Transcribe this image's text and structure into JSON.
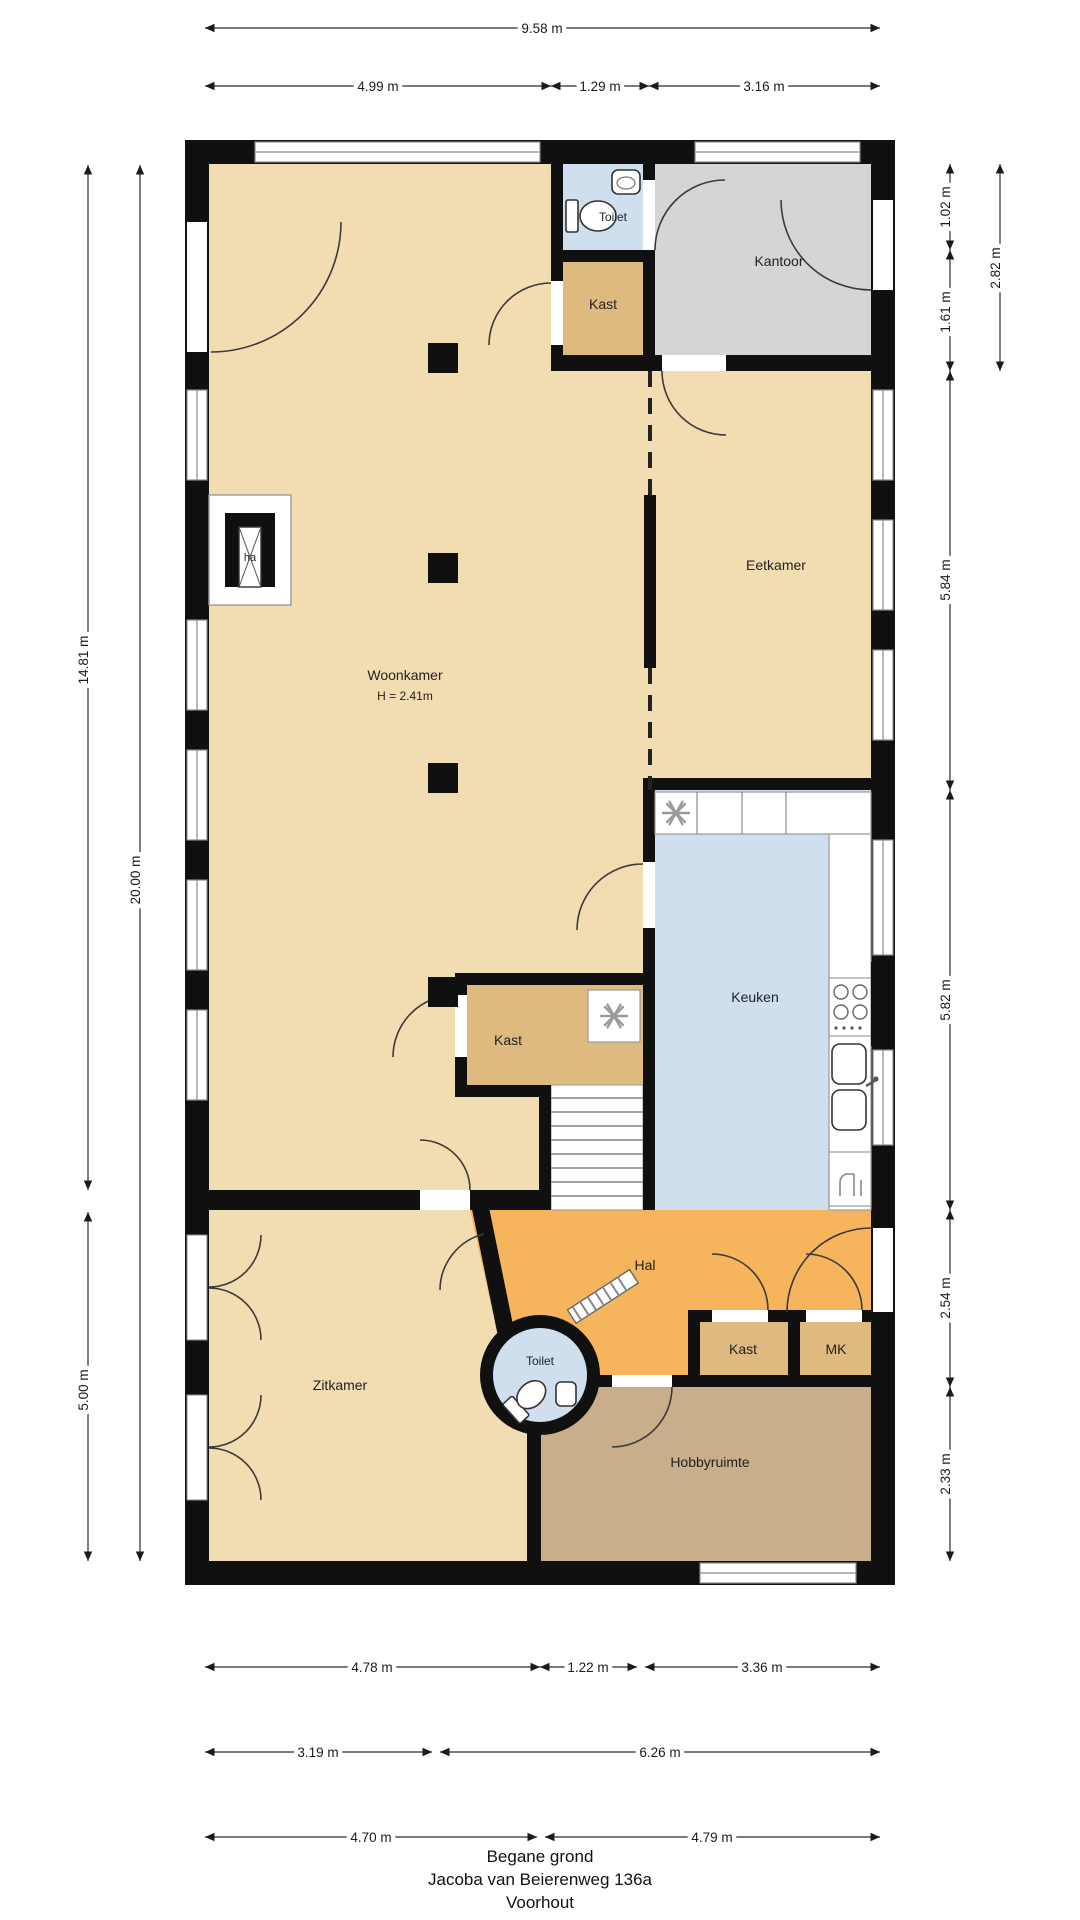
{
  "title": {
    "l1": "Begane grond",
    "l2": "Jacoba van Beierenweg 136a",
    "l3": "Voorhout"
  },
  "rooms": {
    "woonkamer": "Woonkamer",
    "woonkamer_h": "H = 2.41m",
    "eetkamer": "Eetkamer",
    "kantoor": "Kantoor",
    "toilet_top": "Toilet",
    "kast_top": "Kast",
    "keuken": "Keuken",
    "kast_mid": "Kast",
    "hal": "Hal",
    "zitkamer": "Zitkamer",
    "toilet_round": "Toilet",
    "kast_hal": "Kast",
    "mk": "MK",
    "hobbyruimte": "Hobbyruimte",
    "fireplace": "ha"
  },
  "colors": {
    "floor_tan": "#f2dcb2",
    "floor_kast": "#deba80",
    "floor_gray": "#d5d5d5",
    "floor_blue": "#cfdfee",
    "floor_orange": "#f6b55d",
    "floor_hobby": "#c9ae8c",
    "wall": "#101010"
  },
  "dim": {
    "top_total": "9.58 m",
    "top_1": "4.99 m",
    "top_2": "1.29 m",
    "top_3": "3.16 m",
    "left_upper": "14.81 m",
    "left_lower": "5.00 m",
    "left_total": "20.00 m",
    "right_1": "1.02 m",
    "right_2": "1.61 m",
    "right_12": "2.82 m",
    "right_3": "5.84 m",
    "right_4": "5.82 m",
    "right_5": "2.54 m",
    "right_6": "2.33 m",
    "bot_r1_1": "4.78 m",
    "bot_r1_2": "1.22 m",
    "bot_r1_3": "3.36 m",
    "bot_r2_1": "3.19 m",
    "bot_r2_2": "6.26 m",
    "bot_r3_1": "4.70 m",
    "bot_r3_2": "4.79 m"
  }
}
